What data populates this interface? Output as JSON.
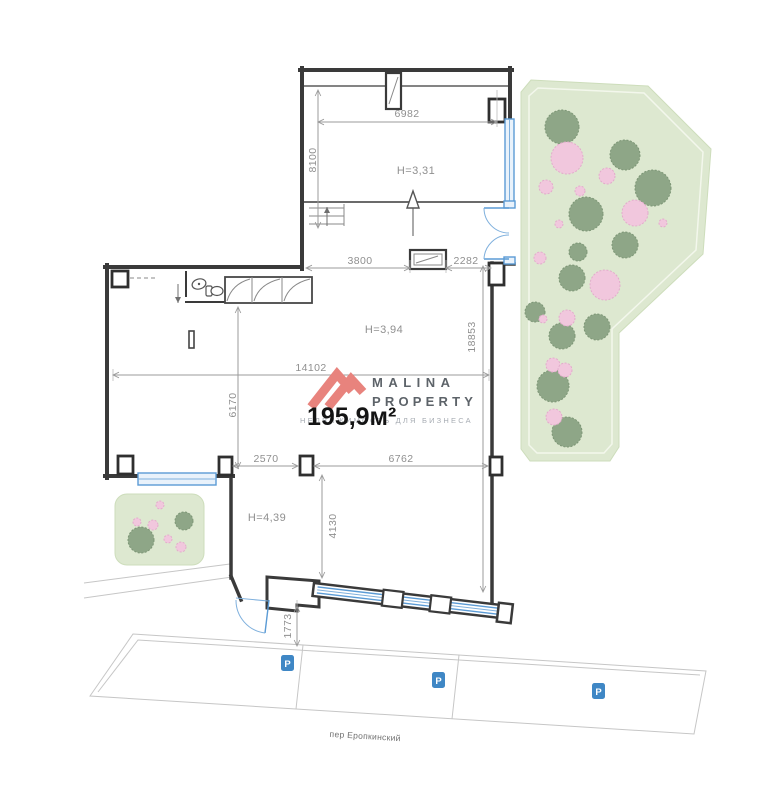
{
  "plan": {
    "dims": {
      "d6982": "6982",
      "d8100": "8100",
      "d3800": "3800",
      "d2282": "2282",
      "d14102": "14102",
      "d18853": "18853",
      "d6170": "6170",
      "d2570": "2570",
      "d6762": "6762",
      "d4130": "4130",
      "d1773": "1773"
    },
    "heights": {
      "h1": "H=3,31",
      "h2": "H=3,94",
      "h3": "H=4,39"
    },
    "street": {
      "name": "пер Еропкинский",
      "parking_icon": "P"
    },
    "colors": {
      "wall": "#3a3a3a",
      "dimension": "#9b9b9b",
      "accent_blue": "#5b9bd5",
      "parking_blue": "#3f87c5",
      "garden_fill": "#dde8d0",
      "tree_green": "#8ea687",
      "tree_pink": "#f1c7dd",
      "logo_red": "#e8837d"
    },
    "garden": {
      "trees": [
        {
          "x": 562,
          "y": 127,
          "r": 17,
          "t": "g"
        },
        {
          "x": 625,
          "y": 155,
          "r": 15,
          "t": "g"
        },
        {
          "x": 653,
          "y": 188,
          "r": 18,
          "t": "g"
        },
        {
          "x": 586,
          "y": 214,
          "r": 17,
          "t": "g"
        },
        {
          "x": 625,
          "y": 245,
          "r": 13,
          "t": "g"
        },
        {
          "x": 578,
          "y": 252,
          "r": 9,
          "t": "g"
        },
        {
          "x": 572,
          "y": 278,
          "r": 13,
          "t": "g"
        },
        {
          "x": 535,
          "y": 312,
          "r": 10,
          "t": "g"
        },
        {
          "x": 562,
          "y": 336,
          "r": 13,
          "t": "g"
        },
        {
          "x": 597,
          "y": 327,
          "r": 13,
          "t": "g"
        },
        {
          "x": 553,
          "y": 386,
          "r": 16,
          "t": "g"
        },
        {
          "x": 567,
          "y": 432,
          "r": 15,
          "t": "g"
        },
        {
          "x": 567,
          "y": 158,
          "r": 16,
          "t": "p"
        },
        {
          "x": 546,
          "y": 187,
          "r": 7,
          "t": "p"
        },
        {
          "x": 607,
          "y": 176,
          "r": 8,
          "t": "p"
        },
        {
          "x": 580,
          "y": 191,
          "r": 5,
          "t": "p"
        },
        {
          "x": 635,
          "y": 213,
          "r": 13,
          "t": "p"
        },
        {
          "x": 559,
          "y": 224,
          "r": 4,
          "t": "p"
        },
        {
          "x": 663,
          "y": 223,
          "r": 4,
          "t": "p"
        },
        {
          "x": 540,
          "y": 258,
          "r": 6,
          "t": "p"
        },
        {
          "x": 605,
          "y": 285,
          "r": 15,
          "t": "p"
        },
        {
          "x": 543,
          "y": 319,
          "r": 4,
          "t": "p"
        },
        {
          "x": 567,
          "y": 318,
          "r": 8,
          "t": "p"
        },
        {
          "x": 553,
          "y": 365,
          "r": 7,
          "t": "p"
        },
        {
          "x": 565,
          "y": 370,
          "r": 7,
          "t": "p"
        },
        {
          "x": 554,
          "y": 417,
          "r": 8,
          "t": "p"
        }
      ],
      "small_garden_trees": [
        {
          "x": 184,
          "y": 521,
          "r": 9,
          "t": "g"
        },
        {
          "x": 141,
          "y": 540,
          "r": 13,
          "t": "g"
        },
        {
          "x": 160,
          "y": 505,
          "r": 4,
          "t": "p"
        },
        {
          "x": 137,
          "y": 522,
          "r": 4,
          "t": "p"
        },
        {
          "x": 153,
          "y": 525,
          "r": 5,
          "t": "p"
        },
        {
          "x": 168,
          "y": 539,
          "r": 4,
          "t": "p"
        },
        {
          "x": 181,
          "y": 547,
          "r": 5,
          "t": "p"
        }
      ]
    }
  },
  "watermark": {
    "brand_line1": "MALINA",
    "brand_line2": "PROPERTY",
    "tagline": "НЕДВИЖИМОСТЬ ДЛЯ БИЗНЕСА",
    "area": "195,9м²"
  }
}
